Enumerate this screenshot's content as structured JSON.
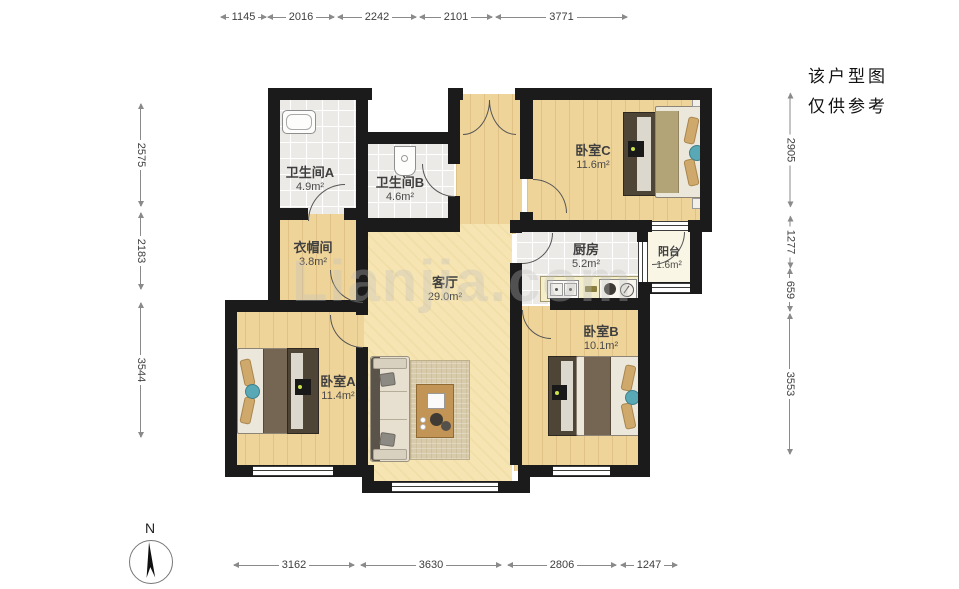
{
  "disclaimer": {
    "line1": "该户型图",
    "line2": "仅供参考"
  },
  "compass": {
    "label": "N"
  },
  "watermark": {
    "text": "Lianjia.com"
  },
  "dimensions": {
    "top": [
      {
        "v": "1145"
      },
      {
        "v": "2016"
      },
      {
        "v": "2242"
      },
      {
        "v": "2101"
      },
      {
        "v": "3771"
      }
    ],
    "bottom": [
      {
        "v": "3162"
      },
      {
        "v": "3630"
      },
      {
        "v": "2806"
      },
      {
        "v": "1247"
      }
    ],
    "left": [
      {
        "v": "2575"
      },
      {
        "v": "2183"
      },
      {
        "v": "3544"
      }
    ],
    "right": [
      {
        "v": "2905"
      },
      {
        "v": "1277"
      },
      {
        "v": "659"
      },
      {
        "v": "3553"
      }
    ]
  },
  "rooms": {
    "bathroom_a": {
      "name": "卫生间A",
      "area": "4.9m²"
    },
    "bathroom_b": {
      "name": "卫生间B",
      "area": "4.6m²"
    },
    "cloakroom": {
      "name": "衣帽间",
      "area": "3.8m²"
    },
    "bedroom_c": {
      "name": "卧室C",
      "area": "11.6m²"
    },
    "kitchen": {
      "name": "厨房",
      "area": "5.2m²"
    },
    "balcony": {
      "name": "阳台",
      "area": "1.6m²"
    },
    "living_room": {
      "name": "客厅",
      "area": "29.0m²"
    },
    "bedroom_a": {
      "name": "卧室A",
      "area": "11.4m²"
    },
    "bedroom_b": {
      "name": "卧室B",
      "area": "10.1m²"
    }
  },
  "colors": {
    "wall": "#1b1b1b",
    "wood_floor": "#efd49a",
    "living_floor": "#f6e5b2",
    "tile_floor": "#eceae6",
    "accent_teal": "#58a8b5"
  }
}
